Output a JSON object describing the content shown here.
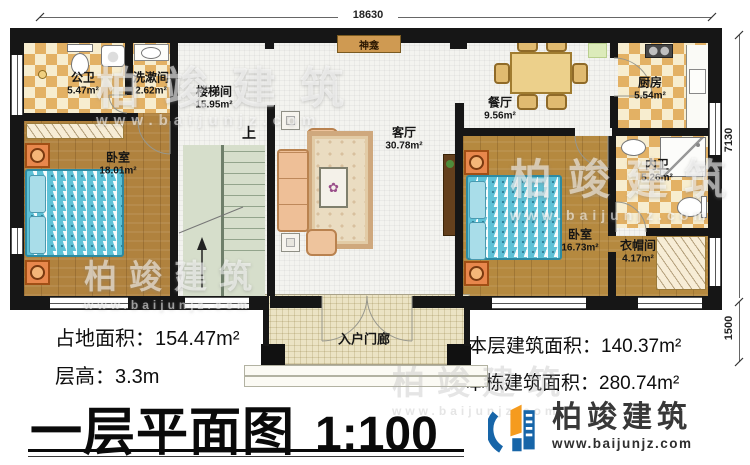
{
  "dimensions": {
    "top": "18630",
    "right_upper": "7130",
    "right_lower": "1500"
  },
  "rooms": [
    {
      "name": "公卫",
      "area": "5.47m²"
    },
    {
      "name": "洗漱间",
      "area": "2.62m²"
    },
    {
      "name": "楼梯间",
      "area": "15.95m²"
    },
    {
      "name": "客厅",
      "area": "30.78m²"
    },
    {
      "name": "餐厅",
      "area": "9.56m²"
    },
    {
      "name": "厨房",
      "area": "5.54m²"
    },
    {
      "name": "内卫",
      "area": "5.26m²"
    },
    {
      "name": "卧室",
      "area": "18.01m²"
    },
    {
      "name": "卧室",
      "area": "16.73m²"
    },
    {
      "name": "衣帽间",
      "area": "4.17m²"
    },
    {
      "name": "入户门廊",
      "area": ""
    }
  ],
  "markers": {
    "shrine": "神龛",
    "stairs_up": "上"
  },
  "stats": {
    "land_area": "占地面积：154.47m²",
    "floor_height": "层高：3.3m",
    "floor_area": "本层建筑面积：140.37m²",
    "building_area": "本栋建筑面积：280.74m²"
  },
  "title": {
    "main": "一层平面图",
    "scale": "1:100"
  },
  "logo": {
    "name": "柏竣建筑",
    "url": "www.baijunjz.com"
  },
  "watermark": {
    "text": "柏竣建筑",
    "sub": "www.baijunjz.com"
  },
  "colors": {
    "wall": "#161616",
    "tile_dark": "#e3b164",
    "tile_light": "#f7edcf",
    "wood": "#b0823e",
    "bed_blue": "#5ec1d6",
    "logo_blue": "#1765a8",
    "logo_orange": "#f59b1e"
  }
}
